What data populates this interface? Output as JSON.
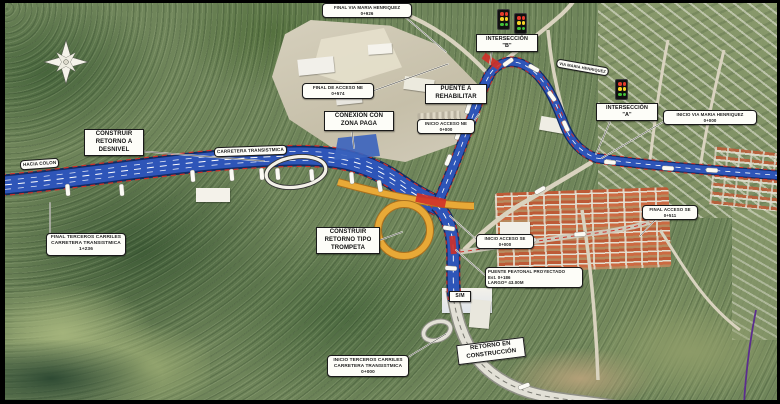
{
  "map_type": "aerial-roadworks-plan",
  "colors": {
    "road_blue": "#2e55b8",
    "road_casing": "#122b63",
    "lane_dash_white": "#ffffff",
    "edge_dash_red": "#d03028",
    "ramp_orange": "#e8a937",
    "ramp_casing": "#a86f1f",
    "construction_grey": "#e2e0d6",
    "construction_casing": "#8f8f86",
    "label_bg": "#fdfdf8",
    "label_text": "#111111",
    "signal_red": "#e53b2c",
    "signal_yellow": "#f5d327",
    "signal_green": "#43c03a",
    "boundary_purple": "#5b2d8e"
  },
  "icons": {
    "compass": "compass-rose",
    "intersection_signal": "traffic-light-icon"
  },
  "labels": {
    "construir_retorno_desnivel": {
      "lines": [
        "CONSTRUIR",
        "RETORNO A",
        "DESNIVEL"
      ]
    },
    "hacia_colon": {
      "lines": [
        "HACIA COLON"
      ]
    },
    "carretera_transistmica": {
      "lines": [
        "CARRETERA TRANSISTMICA"
      ]
    },
    "final_terceros_carriles": {
      "lines": [
        "FINAL TERCEROS CARRILES",
        "CARRETERA TRANSISTMICA",
        "1+236"
      ]
    },
    "final_via_maria_henriquez": {
      "lines": [
        "FINAL VIA MARIA HENRIQUEZ",
        "0+926"
      ]
    },
    "final_de_acceso_ne": {
      "lines": [
        "FINAL DE ACCESO NE",
        "0+574"
      ]
    },
    "conexion_zona_paga": {
      "lines": [
        "CONEXIÓN CON",
        "ZONA PAGA"
      ]
    },
    "puente_a_rehabilitar": {
      "lines": [
        "PUENTE A",
        "REHABILITAR"
      ]
    },
    "interseccion_b": {
      "lines": [
        "INTERSECCIÓN",
        "\"B\""
      ]
    },
    "interseccion_a": {
      "lines": [
        "INTERSECCIÓN",
        "\"A\""
      ]
    },
    "via_maria_henriquez": {
      "lines": [
        "VIA MARIA HENRIQUEZ"
      ]
    },
    "inicio_via_maria_henriquez": {
      "lines": [
        "INICIO VIA MARIA HENRIQUEZ",
        "0+000"
      ]
    },
    "inicio_acceso_ne": {
      "lines": [
        "INICIO ACCESO NE",
        "0+000"
      ]
    },
    "final_acceso_se": {
      "lines": [
        "FINAL ACCESO SE",
        "0+511"
      ]
    },
    "inicio_acceso_se": {
      "lines": [
        "INICIO ACCESO SE",
        "0+000"
      ]
    },
    "puente_peatonal": {
      "lines": [
        "PUENTE PEATONAL PROYECTADO",
        "Est. 0+186",
        "LARGO= 43.00M"
      ]
    },
    "sm_badge": {
      "lines": [
        "S/M"
      ]
    },
    "construir_retorno_trompeta": {
      "lines": [
        "CONSTRUIR",
        "RETORNO TIPO",
        "TROMPETA"
      ]
    },
    "inicio_terceros_carriles": {
      "lines": [
        "INICIO TERCEROS CARRILES",
        "CARRETERA TRANSISTMICA",
        "0+000"
      ]
    },
    "retorno_en_construccion": {
      "lines": [
        "RETORNO EN",
        "CONSTRUCCIÓN"
      ]
    }
  }
}
